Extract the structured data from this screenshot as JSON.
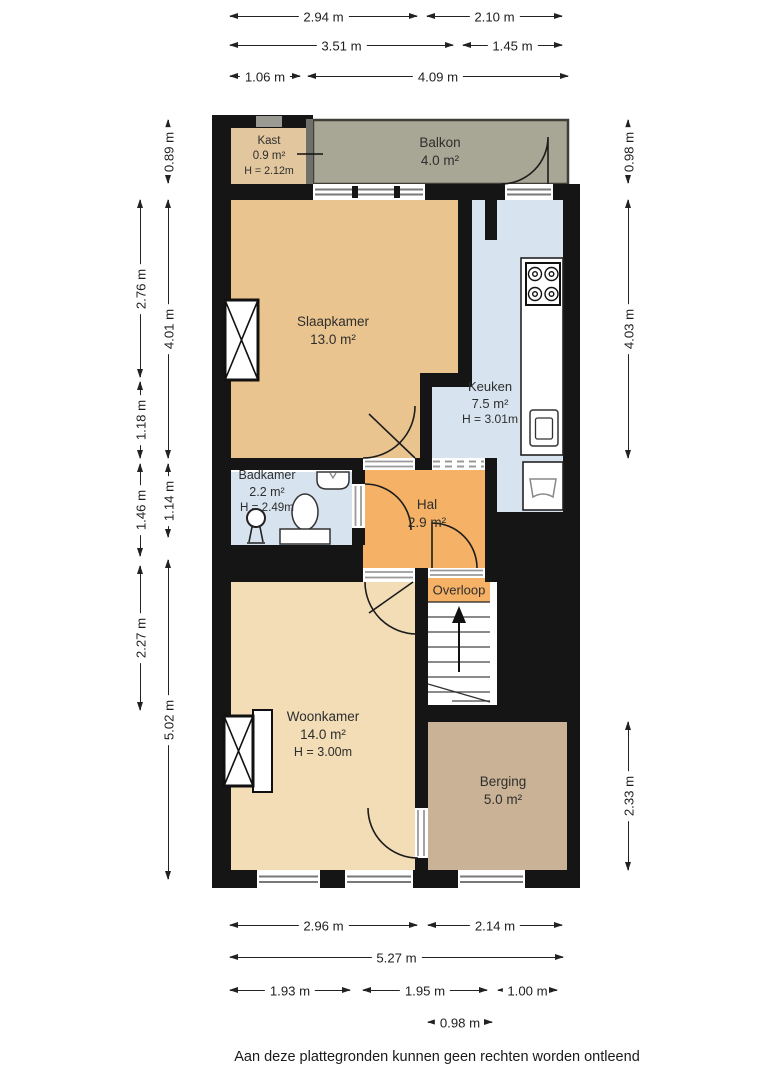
{
  "rooms": {
    "kast": {
      "name": "Kast",
      "area": "0.9 m²",
      "height": "H = 2.12m"
    },
    "balkon": {
      "name": "Balkon",
      "area": "4.0 m²"
    },
    "slaapkamer": {
      "name": "Slaapkamer",
      "area": "13.0 m²"
    },
    "keuken": {
      "name": "Keuken",
      "area": "7.5 m²",
      "height": "H = 3.01m"
    },
    "badkamer": {
      "name": "Badkamer",
      "area": "2.2 m²",
      "height": "H = 2.49m"
    },
    "hal": {
      "name": "Hal",
      "area": "2.9 m²"
    },
    "overloop": {
      "name": "Overloop"
    },
    "woonkamer": {
      "name": "Woonkamer",
      "area": "14.0 m²",
      "height": "H = 3.00m"
    },
    "berging": {
      "name": "Berging",
      "area": "5.0 m²"
    }
  },
  "dimensions": {
    "top": [
      "2.94 m",
      "2.10 m",
      "3.51 m",
      "1.45 m",
      "1.06 m",
      "4.09 m"
    ],
    "bottom": [
      "2.96 m",
      "2.14 m",
      "5.27 m",
      "1.93 m",
      "1.95 m",
      "1.00 m",
      "0.98 m"
    ],
    "left": [
      "0.89 m",
      "2.76 m",
      "4.01 m",
      "1.18 m",
      "1.14 m",
      "1.46 m",
      "2.27 m",
      "5.02 m"
    ],
    "right": [
      "0.98 m",
      "4.03 m",
      "2.33 m"
    ]
  },
  "footer": {
    "disclaimer": "Aan deze plattegronden kunnen geen rechten worden ontleend"
  },
  "colors": {
    "wall": "#151515",
    "kast": "#E2C79E",
    "balkon": "#A8A694",
    "slaapkamer": "#EAC48E",
    "keuken_badkamer": "#D7E4EF",
    "hal_overloop": "#F5B266",
    "woonkamer": "#F2DDB6",
    "berging": "#C9B295"
  }
}
